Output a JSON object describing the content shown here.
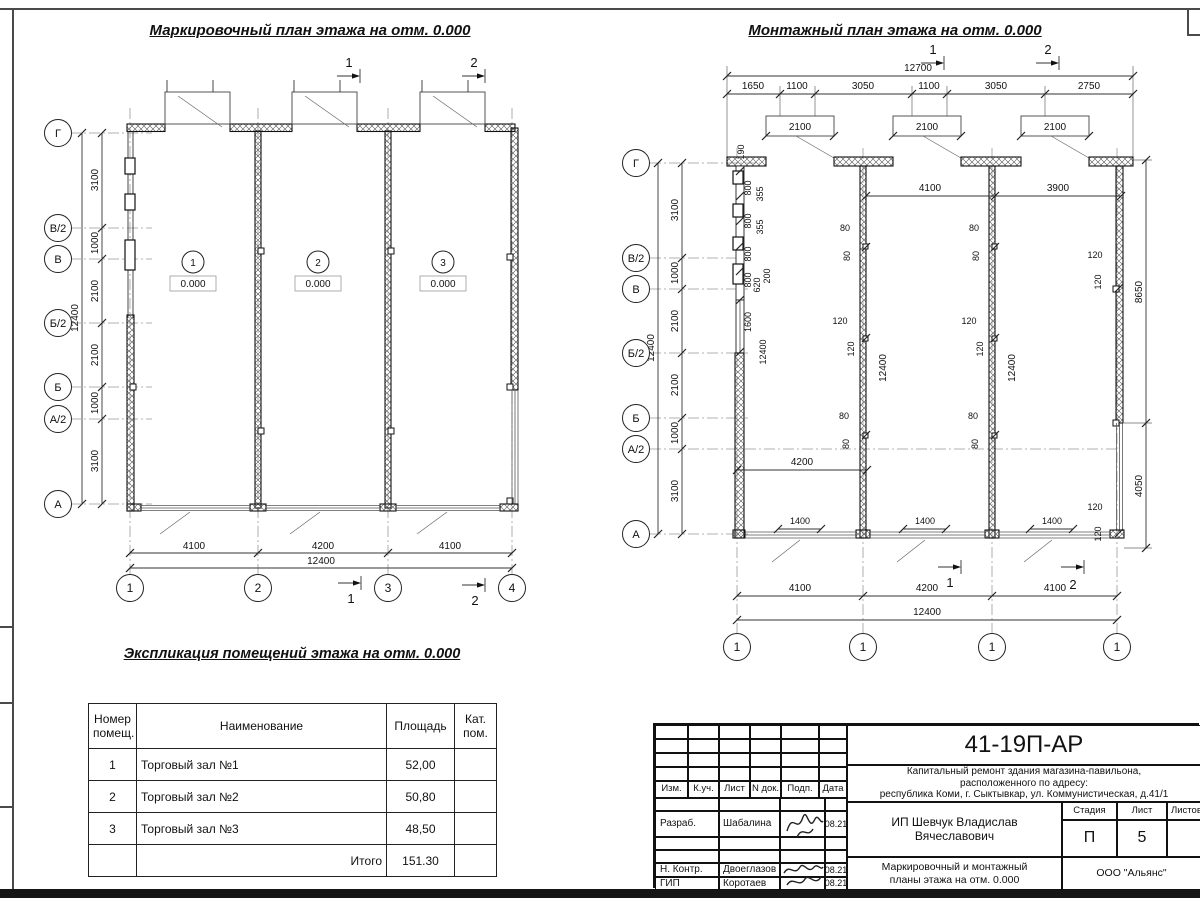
{
  "left_plan": {
    "title": "Маркировочный план этажа на отм. 0.000",
    "axes": [
      "Г",
      "В/2",
      "В",
      "Б/2",
      "Б",
      "А/2",
      "А"
    ],
    "axis_dims": [
      "3100",
      "1000",
      "2100",
      "2100",
      "1000",
      "3100"
    ],
    "axis_total": "12400",
    "cols": [
      "1",
      "2",
      "3",
      "4"
    ],
    "bottom_dims": [
      "4100",
      "4200",
      "4100"
    ],
    "bottom_total": "12400",
    "rooms": [
      "1",
      "2",
      "3"
    ],
    "room_elev": "0.000",
    "sec1": "1",
    "sec2": "2"
  },
  "right_plan": {
    "title": "Монтажный план этажа на отм. 0.000",
    "axes": [
      "Г",
      "В/2",
      "В",
      "Б/2",
      "Б",
      "А/2",
      "А"
    ],
    "axis_dims": [
      "3100",
      "1000",
      "2100",
      "2100",
      "1000",
      "3100"
    ],
    "axis_total": "12400",
    "top_total": "12700",
    "top_dims": [
      "1650",
      "1100",
      "3050",
      "1100",
      "3050",
      "2750"
    ],
    "door_dim": "2100",
    "inner_dims": [
      "4100",
      "3900"
    ],
    "mid_dim": "4200",
    "wall_dims": [
      "190",
      "800",
      "355",
      "800",
      "355",
      "800",
      "800",
      "620",
      "200",
      "1600"
    ],
    "wall_total": "12400",
    "d80": "80",
    "d120": "120",
    "right_dims": [
      "8650",
      "4050"
    ],
    "small_dim": "1400",
    "bottom_dims": [
      "4100",
      "4200",
      "4100"
    ],
    "bottom_total": "12400",
    "cols": [
      "1",
      "1",
      "1",
      "1"
    ],
    "sec1": "1",
    "sec2": "2"
  },
  "table": {
    "title": "Экспликация помещений этажа на отм. 0.000",
    "headers": [
      "Номер\nпомещ.",
      "Наименование",
      "Площадь",
      "Кат.\nпом."
    ],
    "rows": [
      [
        "1",
        "Торговый зал №1",
        "52,00",
        ""
      ],
      [
        "2",
        "Торговый зал №2",
        "50,80",
        ""
      ],
      [
        "3",
        "Торговый зал №3",
        "48,50",
        ""
      ]
    ],
    "total_label": "Итого",
    "total_value": "151.30"
  },
  "title_block": {
    "doc_number": "41-19П-АР",
    "project": "Капитальный ремонт здания магазина-павильона,\nрасположенного по адресу:\nреспублика Коми, г. Сыктывкар, ул. Коммунистическая, д.41/1",
    "cols": [
      "Изм.",
      "К.уч.",
      "Лист",
      "N док.",
      "Подп.",
      "Дата"
    ],
    "rows": [
      {
        "role": "Разраб.",
        "name": "Шабалина",
        "date": "08.21"
      },
      {
        "role": "Н. Контр.",
        "name": "Двоеглазов",
        "date": "08.21"
      },
      {
        "role": "ГИП",
        "name": "Коротаев",
        "date": "08.21"
      }
    ],
    "client": "ИП Шевчук Владислав\nВячеславович",
    "stage_label": "Стадия",
    "sheet_label": "Лист",
    "sheets_label": "Листов",
    "stage": "П",
    "sheet_number": "5",
    "drawing_title": "Маркировочный и монтажный\nпланы этажа на отм. 0.000",
    "company": "ООО \"Альянс\""
  }
}
